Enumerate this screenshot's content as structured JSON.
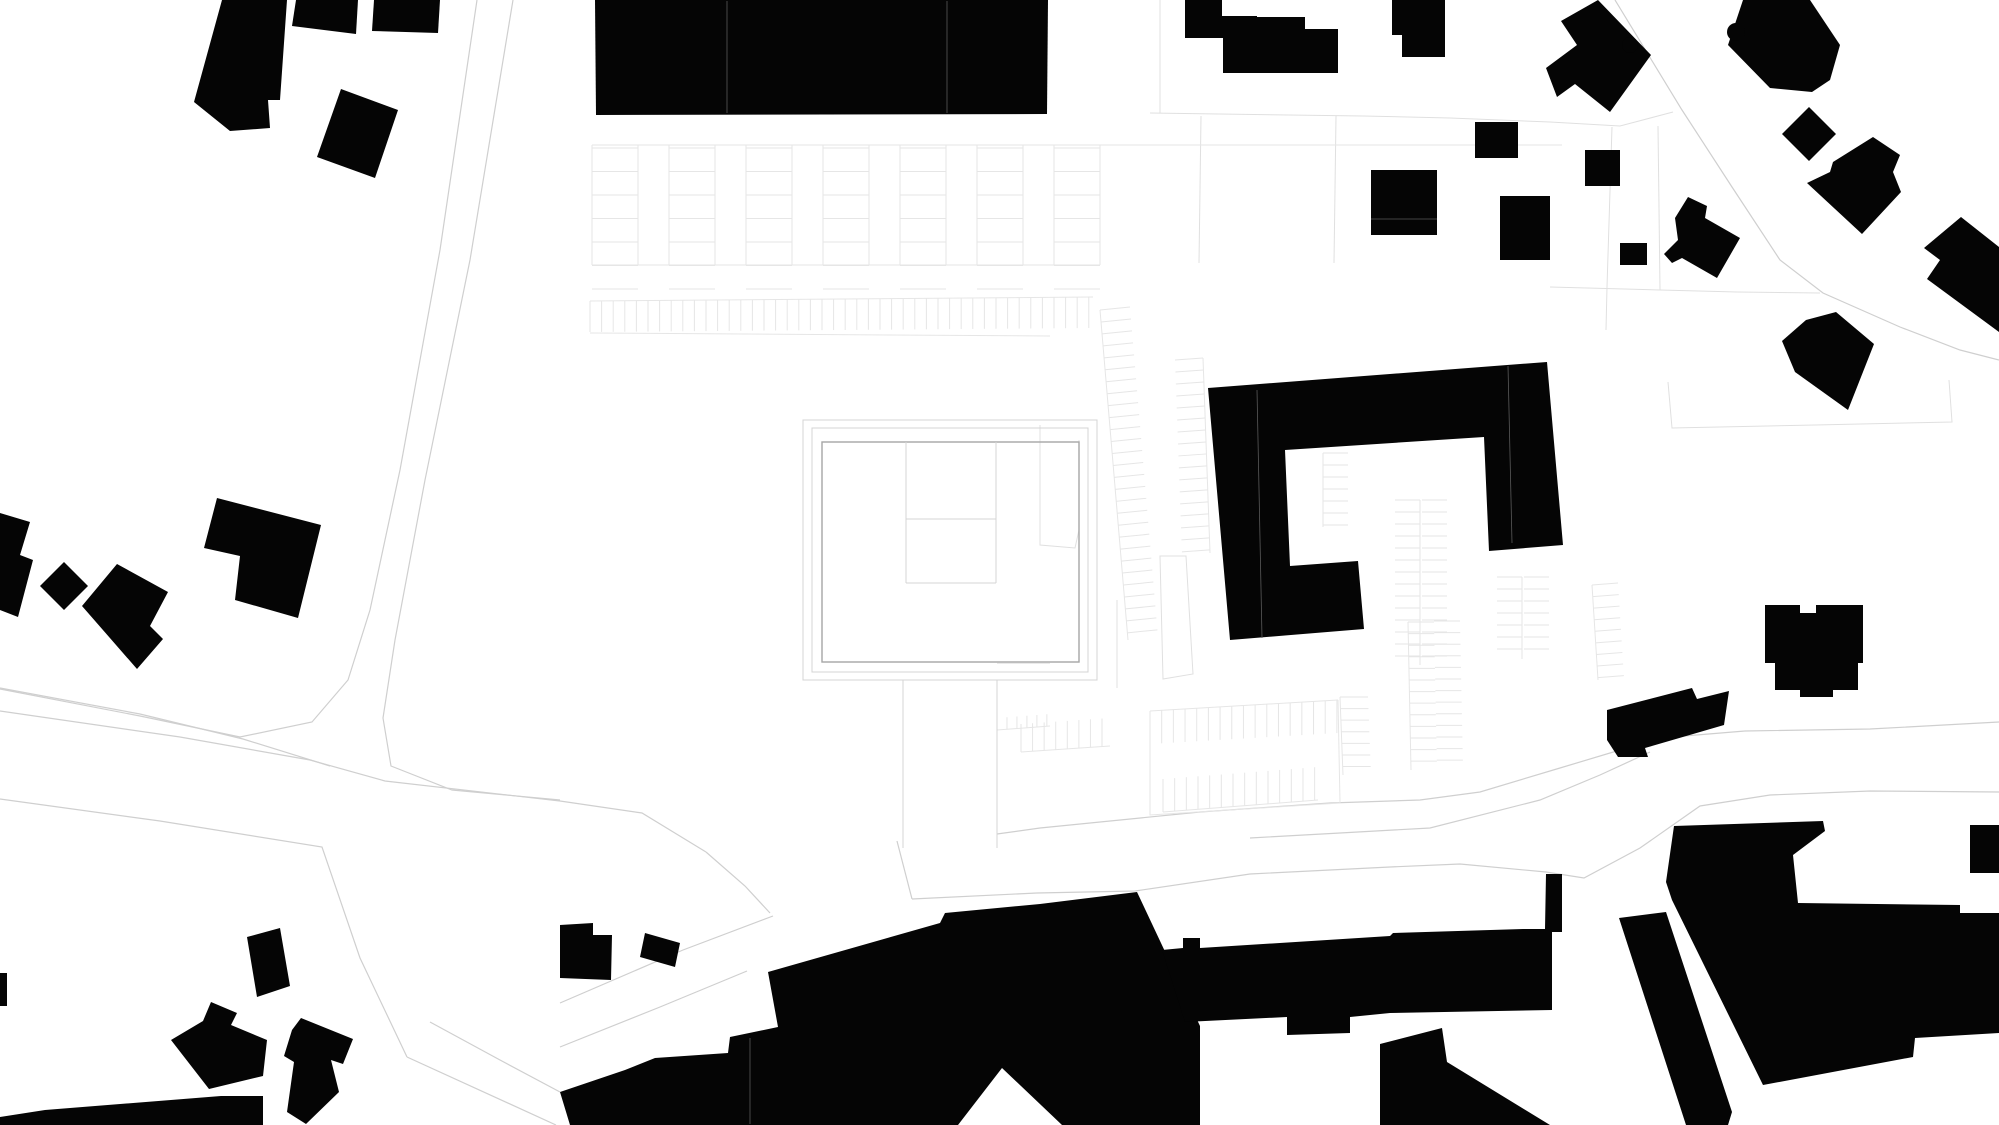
{
  "canvas": {
    "width": 1999,
    "height": 1125,
    "background": "#ffffff"
  },
  "colors": {
    "building": "#050505",
    "road_line": "#cfcfcf",
    "parcel_line": "#e0e0e0",
    "tick_line": "#e6e6e6",
    "plaza_ring": "#d4d4d4",
    "plaza_square": "#a6a6a6",
    "seam": "#5a5a5a"
  },
  "buildings": [
    {
      "name": "building-topleft-slab",
      "points": "222,0 287,0 280,100 268,100 270,128 230,131 194,102"
    },
    {
      "name": "building-topleft-wing-a",
      "points": "296,0 358,0 356,34 292,26"
    },
    {
      "name": "building-topleft-wing-b",
      "points": "374,0 440,0 438,33 372,31"
    },
    {
      "name": "building-topleft-diamond",
      "points": "341,89 398,110 375,178 317,157"
    },
    {
      "name": "building-long-bar",
      "points": "595,0 1048,0 1047,114 596,115"
    },
    {
      "name": "building-step-a",
      "points": "1185,0 1222,0 1222,38 1185,38"
    },
    {
      "name": "building-step-b",
      "points": "1190,16 1257,16 1257,38 1190,38"
    },
    {
      "name": "building-step-c",
      "points": "1223,17 1305,17 1305,29 1338,29 1338,73 1223,73"
    },
    {
      "name": "building-north-house",
      "points": "1392,0 1445,0 1445,57 1402,57 1402,35 1392,35"
    },
    {
      "name": "building-square-a",
      "points": "1475,122 1518,122 1518,158 1475,158"
    },
    {
      "name": "building-square-b",
      "points": "1371,170 1437,170 1437,235 1371,235"
    },
    {
      "name": "building-square-c",
      "points": "1500,196 1550,196 1550,260 1500,260"
    },
    {
      "name": "building-ne-cross-house",
      "points": "1598,0 1651,55 1610,112 1575,84 1557,97 1546,68 1577,45 1561,21"
    },
    {
      "name": "building-ne-big-house",
      "points": "1743,0 1810,0 1840,45 1830,80 1812,92 1770,88 1728,45"
    },
    {
      "name": "building-ne-diamond",
      "points": "1809,107 1836,134 1809,161 1782,134"
    },
    {
      "name": "building-ne-l-house",
      "points": "1833,162 1873,137 1900,155 1893,172 1901,192 1862,234 1807,183 1830,172"
    },
    {
      "name": "building-square-d",
      "points": "1585,150 1620,150 1620,186 1585,186"
    },
    {
      "name": "building-rect-e",
      "points": "1620,243 1647,243 1647,265 1620,265"
    },
    {
      "name": "building-step-house-e",
      "points": "1675,218 1688,197 1707,206 1705,218 1740,238 1717,278 1682,258 1672,263 1664,254 1678,240"
    },
    {
      "name": "building-se-corner-house",
      "points": "1961,217 1999,247 1999,332 1927,279 1940,260 1924,248"
    },
    {
      "name": "building-e-house-a",
      "points": "1836,312 1874,344 1848,410 1795,372 1782,341 1806,320"
    },
    {
      "name": "building-e-house-b",
      "points": "1765,605 1800,605 1800,613 1816,613 1816,605 1863,605 1863,663 1858,663 1858,690 1833,690 1833,697 1800,697 1800,690 1775,690 1775,663 1765,663"
    },
    {
      "name": "building-e-slab",
      "points": "1607,710 1692,688 1697,699 1729,691 1724,725 1645,748 1648,757 1618,757 1607,740"
    },
    {
      "name": "building-w-edge-piece",
      "points": "0,513 30,522 20,555 33,560 18,617 0,610"
    },
    {
      "name": "building-w-diamond",
      "points": "64,562 88,586 64,610 40,586"
    },
    {
      "name": "building-w-house",
      "points": "117,564 168,592 150,626 163,639 137,669 82,606"
    },
    {
      "name": "building-w-pair-house",
      "points": "217,498 321,525 298,618 235,600 240,556 204,548"
    },
    {
      "name": "building-w-sliver",
      "points": "0,973 7,973 7,1006 0,1006"
    },
    {
      "name": "building-sw-rot-house",
      "points": "247,937 280,928 290,986 257,997"
    },
    {
      "name": "building-sw-house-a",
      "points": "211,1002 237,1013 231,1025 267,1040 263,1076 209,1089 171,1040 203,1021"
    },
    {
      "name": "building-sw-house-b",
      "points": "301,1018 353,1039 343,1064 331,1060 339,1092 306,1124 287,1112 294,1062 284,1056 292,1030"
    },
    {
      "name": "building-sw-slab",
      "points": "0,1117 45,1110 221,1096 263,1096 263,1125 0,1125"
    },
    {
      "name": "building-road-notch-house",
      "points": "560,925 593,923 593,935 612,935 611,980 560,978"
    },
    {
      "name": "building-road-small-rect",
      "points": "645,933 680,943 675,967 640,957"
    },
    {
      "name": "building-south-complex-west",
      "points": "768,972 940,923 945,913 1040,904 1137,892 1200,1026 1200,1125 1062,1125 1002,1068 958,1125 570,1125 560,1092 625,1070 655,1058 728,1053 730,1037 778,1027"
    },
    {
      "name": "building-south-band",
      "points": "1162,950 1183,948 1183,938 1200,938 1200,948 1390,936 1393,933 1523,929 1545,929 1546,874 1562,874 1562,932 1552,932 1552,1010 1390,1013 1350,1017 1350,1033 1287,1035 1287,1017 1185,1022"
    },
    {
      "name": "building-south-lower-slab",
      "points": "1380,1044 1442,1028 1447,1062 1550,1125 1380,1125"
    },
    {
      "name": "building-south-tower",
      "points": "1619,918 1666,912 1732,1112 1728,1125 1686,1125"
    },
    {
      "name": "building-south-mass-east",
      "points": "1666,882 1674,826 1823,821 1825,831 1793,855 1798,903 1960,905 1960,913 1999,913 1999,1033 1915,1038 1913,1057 1763,1085 1672,900"
    },
    {
      "name": "building-se-sliver",
      "points": "1970,825 1999,825 1999,873 1970,873"
    },
    {
      "name": "building-courtyard-c",
      "points": "1208,388 1547,362 1563,545 1489,551 1484,437 1285,450 1290,566 1358,561 1364,629 1230,640"
    }
  ],
  "building_circles": [
    {
      "name": "building-ne-big-house-bump",
      "cx": 1736,
      "cy": 32,
      "r": 9
    },
    {
      "name": "building-ne-cross-house-bump",
      "cx": 1630,
      "cy": 45,
      "r": 8
    }
  ],
  "roads": [
    {
      "name": "road-left-west-edge",
      "points": "477,0 440,250 400,470 370,610 348,680 312,722 240,737 140,716 0,689"
    },
    {
      "name": "road-left-east-edge",
      "points": "513,0 470,260 425,480 395,640 383,718 391,766 452,790 560,800"
    },
    {
      "name": "road-path-north",
      "points": "0,688 140,714 243,739 330,766"
    },
    {
      "name": "road-main-north",
      "points": "0,711 180,737 310,760 385,781 560,801 642,813 706,852"
    },
    {
      "name": "road-mouth-west",
      "points": "706,852 745,886 770,913"
    },
    {
      "name": "road-mouth-east",
      "points": "897,841 912,899"
    },
    {
      "name": "road-main-south-west",
      "points": "0,799 160,821 322,847 360,958 407,1057"
    },
    {
      "name": "road-se-branch-west",
      "points": "407,1057 556,1125"
    },
    {
      "name": "road-se-branch-east",
      "points": "430,1022 500,1060 560,1092"
    },
    {
      "name": "road-site-line-a",
      "points": "560,1003 683,950 773,916"
    },
    {
      "name": "road-site-line-b",
      "points": "560,1047 660,1007 747,971"
    },
    {
      "name": "road-main-south-east",
      "points": "912,899 1037,893 1135,891 1250,874 1390,867 1460,864 1546,872 1584,878 1640,848 1700,806 1770,795 1870,791 1999,792"
    },
    {
      "name": "road-main-north-east",
      "points": "997,834 1040,828 1200,812 1330,803 1420,800 1480,792 1560,768 1620,750 1660,738 1745,731 1870,729 1999,722"
    },
    {
      "name": "road-inner-line",
      "points": "1250,838 1340,833 1430,828 1540,800 1600,775 1650,752"
    },
    {
      "name": "road-diag-east",
      "points": "1615,0 1682,110 1732,187 1780,260 1823,293 1900,327 1960,350 1999,360"
    }
  ],
  "parcels": [
    {
      "name": "parcel-h-top-right",
      "points": "1363,116 1450,118 1550,122 1620,126 1673,112"
    },
    {
      "name": "parcel-h-mid-right",
      "points": "1550,287 1660,290 1737,292 1820,293"
    },
    {
      "name": "parcel-v-right-a",
      "points": "1612,127 1607,287 1606,330"
    },
    {
      "name": "parcel-v-right-b",
      "points": "1658,126 1660,290"
    },
    {
      "name": "parcel-corner-ne",
      "points": "1668,382 1672,428 1815,425 1952,422 1949,380"
    },
    {
      "name": "parcel-h-top-mid",
      "points": "1150,113 1363,116"
    },
    {
      "name": "parcel-v-top-a",
      "points": "1160,0 1160,113"
    },
    {
      "name": "parcel-v-top-b",
      "points": "1201,116 1199,263"
    },
    {
      "name": "parcel-v-top-c",
      "points": "1336,116 1334,263"
    },
    {
      "name": "parcel-v-topleft",
      "points": "244,0 244,120"
    },
    {
      "name": "parcel-west-walk",
      "points": "1040,425 1040,545 1075,548 1079,530 1079,440"
    },
    {
      "name": "parcel-corridor-east",
      "points": "1117,600 1117,688"
    }
  ],
  "plaza": {
    "outer": {
      "name": "plaza-outer-ring",
      "x": 803,
      "y": 420,
      "w": 294,
      "h": 260
    },
    "ring": {
      "name": "plaza-inner-ring",
      "x": 812,
      "y": 428,
      "w": 276,
      "h": 244
    },
    "square": {
      "name": "plaza-main-square",
      "x": 822,
      "y": 442,
      "w": 257,
      "h": 220
    },
    "lines": [
      {
        "name": "plaza-court-v1",
        "points": "906,442 906,583"
      },
      {
        "name": "plaza-court-v2",
        "points": "996,442 996,583"
      },
      {
        "name": "plaza-court-h1",
        "points": "906,519 996,519"
      },
      {
        "name": "plaza-court-h2",
        "points": "906,583 996,583"
      },
      {
        "name": "plaza-corridor-w",
        "points": "903,680 903,848"
      },
      {
        "name": "plaza-corridor-e",
        "points": "997,680 997,848"
      },
      {
        "name": "plaza-east-h1",
        "points": "997,663 1050,663"
      },
      {
        "name": "plaza-east-h2",
        "points": "997,672 1050,672"
      }
    ],
    "trapezoid": {
      "name": "plaza-ramp",
      "points": "1160,556 1186,556 1193,674 1163,679"
    }
  },
  "parking_grid": {
    "name": "parking-grid-north",
    "x": 592,
    "y": 145,
    "cols": 7,
    "module": 77,
    "stall": 46,
    "rows": 6,
    "row_gap": 23.5,
    "h": 120
  },
  "tick_rows": [
    {
      "name": "stalls-long-row",
      "x1": 590,
      "y1": 301,
      "x2": 1093,
      "y2": 297,
      "tdx": 0,
      "tdy": 31,
      "spacing": 11.6,
      "baseline": true
    },
    {
      "name": "stalls-module-top",
      "x1": 1150,
      "y1": 711,
      "x2": 1338,
      "y2": 700,
      "tdx": 0,
      "tdy": 33,
      "spacing": 11.7,
      "baseline": true
    },
    {
      "name": "stalls-module-bottom",
      "x1": 1163,
      "y1": 812,
      "x2": 1318,
      "y2": 800,
      "tdx": 0,
      "tdy": -33,
      "spacing": 11.7,
      "baseline": true
    },
    {
      "name": "stalls-col-a",
      "x1": 1340,
      "y1": 697,
      "x2": 1343,
      "y2": 775,
      "tdx": 28,
      "tdy": 0,
      "spacing": 11.6,
      "baseline": true
    },
    {
      "name": "stalls-col-b",
      "x1": 1408,
      "y1": 622,
      "x2": 1411,
      "y2": 770,
      "tdx": 26,
      "tdy": 0,
      "spacing": 11.6,
      "baseline": true
    },
    {
      "name": "stalls-col-c",
      "x1": 1434,
      "y1": 621,
      "x2": 1437,
      "y2": 769,
      "tdx": 26,
      "tdy": 0,
      "spacing": 11.6,
      "baseline": false
    },
    {
      "name": "stalls-col-d",
      "x1": 1592,
      "y1": 585,
      "x2": 1598,
      "y2": 680,
      "tdx": 26,
      "tdy": -2,
      "spacing": 11.6,
      "baseline": true
    },
    {
      "name": "stalls-diagonal",
      "x1": 1100,
      "y1": 310,
      "x2": 1128,
      "y2": 640,
      "tdx": 30,
      "tdy": -3,
      "spacing": 12,
      "baseline": true
    },
    {
      "name": "stalls-c-west",
      "x1": 1203,
      "y1": 358,
      "x2": 1210,
      "y2": 553,
      "tdx": -28,
      "tdy": 2,
      "spacing": 12,
      "baseline": true
    },
    {
      "name": "stalls-court-a",
      "x1": 1323,
      "y1": 453,
      "x2": 1323,
      "y2": 527,
      "tdx": 25,
      "tdy": 0,
      "spacing": 12,
      "baseline": true
    },
    {
      "name": "stalls-court-b-left",
      "x1": 1420,
      "y1": 500,
      "x2": 1420,
      "y2": 665,
      "tdx": -25,
      "tdy": 0,
      "spacing": 12,
      "baseline": true
    },
    {
      "name": "stalls-court-b-right",
      "x1": 1422,
      "y1": 500,
      "x2": 1422,
      "y2": 665,
      "tdx": 25,
      "tdy": 0,
      "spacing": 12,
      "baseline": false
    },
    {
      "name": "stalls-court-c-left",
      "x1": 1522,
      "y1": 577,
      "x2": 1522,
      "y2": 659,
      "tdx": -25,
      "tdy": 0,
      "spacing": 12,
      "baseline": true
    },
    {
      "name": "stalls-court-c-right",
      "x1": 1524,
      "y1": 577,
      "x2": 1524,
      "y2": 659,
      "tdx": 25,
      "tdy": 0,
      "spacing": 12,
      "baseline": false
    },
    {
      "name": "stalls-south-a",
      "x1": 1021,
      "y1": 752,
      "x2": 1110,
      "y2": 746,
      "tdx": 0,
      "tdy": -28,
      "spacing": 11.6,
      "baseline": true
    },
    {
      "name": "stalls-south-b",
      "x1": 997,
      "y1": 730,
      "x2": 1050,
      "y2": 726,
      "tdx": 0,
      "tdy": -12,
      "spacing": 10,
      "baseline": true
    }
  ],
  "extra_lines": [
    {
      "name": "stalls-long-row-base",
      "points": "590,333 1050,336"
    },
    {
      "name": "stalls-module-frame",
      "points": "1150,711 1150,815 1340,803 1338,700"
    }
  ],
  "seams": [
    {
      "name": "seam-bar-a",
      "points": "727,1 727,113"
    },
    {
      "name": "seam-bar-b",
      "points": "947,1 947,113"
    },
    {
      "name": "seam-c-building-a",
      "points": "1257,390 1262,638"
    },
    {
      "name": "seam-c-building-b",
      "points": "1508,366 1512,543"
    },
    {
      "name": "seam-south-complex",
      "points": "750,1038 750,1124"
    },
    {
      "name": "seam-square-b",
      "points": "1371,219 1437,219"
    }
  ]
}
